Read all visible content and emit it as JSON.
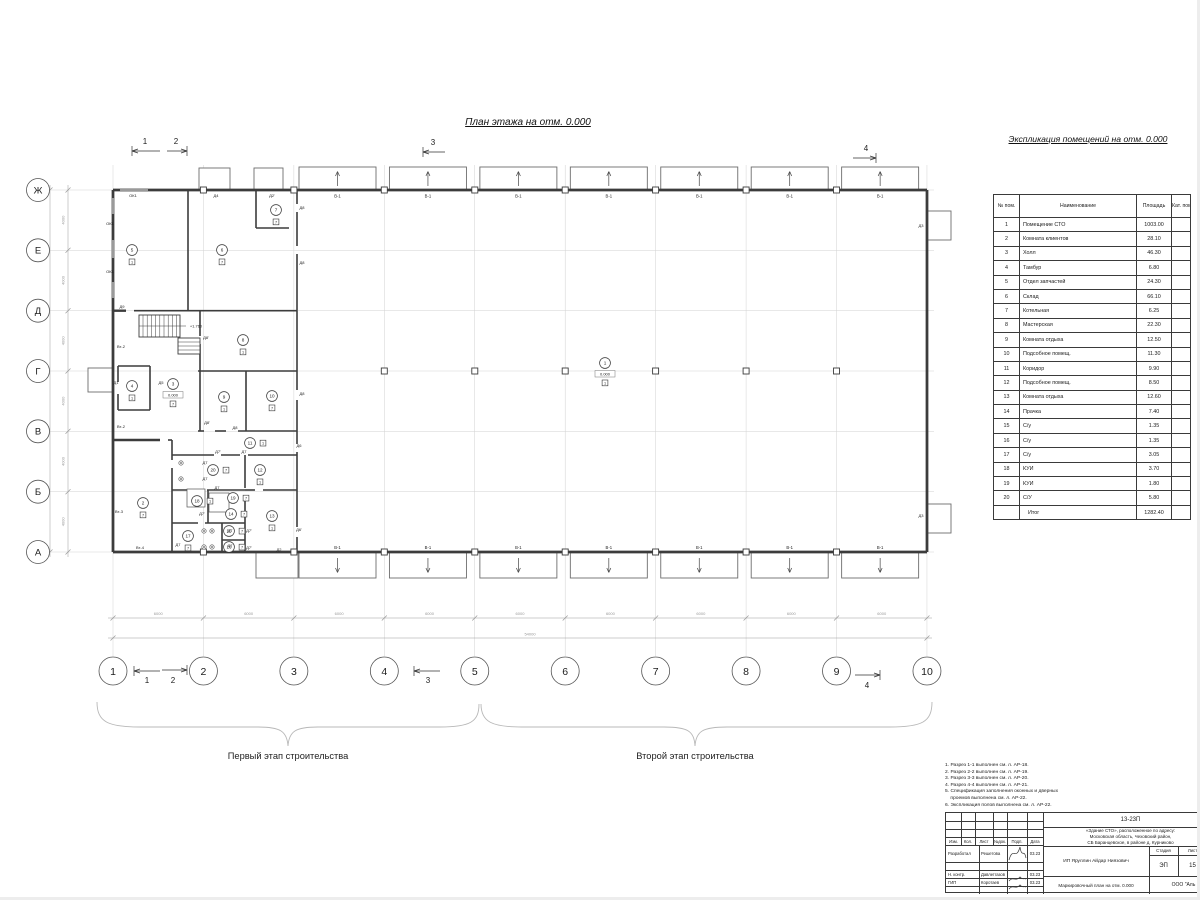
{
  "page": {
    "plan_title": "План этажа на отм. 0.000",
    "stage1": "Первый этап строительства",
    "stage2": "Второй этап строительства"
  },
  "explication": {
    "title": "Экспликация помещений на отм. 0.000",
    "col_num": "№ пом.",
    "col_name": "Наименование",
    "col_area": "Площадь",
    "col_cat": "Кат. пом.",
    "rows": [
      [
        "1",
        "Помещение СТО",
        "1003.00"
      ],
      [
        "2",
        "Комната клиентов",
        "28.10"
      ],
      [
        "3",
        "Холл",
        "46.30"
      ],
      [
        "4",
        "Тамбур",
        "6.80"
      ],
      [
        "5",
        "Отдел запчастей",
        "24.30"
      ],
      [
        "6",
        "Склад",
        "66.10"
      ],
      [
        "7",
        "Котельная",
        "6.25"
      ],
      [
        "8",
        "Мастерская",
        "22.30"
      ],
      [
        "9",
        "Комната отдыха",
        "12.50"
      ],
      [
        "10",
        "Подсобное помещ.",
        "11.30"
      ],
      [
        "11",
        "Коридор",
        "9.90"
      ],
      [
        "12",
        "Подсобное помещ.",
        "8.50"
      ],
      [
        "13",
        "Комната отдыха",
        "12.60"
      ],
      [
        "14",
        "Прачка",
        "7.40"
      ],
      [
        "15",
        "С/у",
        "1.35"
      ],
      [
        "16",
        "С/у",
        "1.35"
      ],
      [
        "17",
        "С/у",
        "3.05"
      ],
      [
        "18",
        "КУИ",
        "3.70"
      ],
      [
        "19",
        "КУИ",
        "1.80"
      ],
      [
        "20",
        "С/У",
        "5.80"
      ]
    ],
    "total_label": "Итог",
    "total": "1282.40"
  },
  "plan": {
    "axes_cols": [
      "1",
      "2",
      "3",
      "4",
      "5",
      "6",
      "7",
      "8",
      "9",
      "10"
    ],
    "axes_rows": [
      "Ж",
      "Е",
      "Д",
      "Г",
      "В",
      "Б",
      "А"
    ],
    "dim_bay": "6000",
    "dim_total_w": "54000",
    "dim_row": "4000",
    "dim_total_h": "24000",
    "gate": "В-1",
    "level_main": "0.000",
    "level_stair": "+1.760",
    "sections": [
      "1",
      "2",
      "3",
      "4"
    ],
    "rooms": [
      {
        "n": "1",
        "x": 605,
        "y": 363,
        "level": "0.000",
        "m": "1"
      },
      {
        "n": "2",
        "x": 143,
        "y": 503,
        "m": "7"
      },
      {
        "n": "3",
        "x": 173,
        "y": 384,
        "level": "0.000",
        "m": "7"
      },
      {
        "n": "4",
        "x": 132,
        "y": 386,
        "m": "1"
      },
      {
        "n": "5",
        "x": 132,
        "y": 250,
        "m": "1"
      },
      {
        "n": "6",
        "x": 222,
        "y": 250,
        "m": "7"
      },
      {
        "n": "7",
        "x": 276,
        "y": 210,
        "m": "7"
      },
      {
        "n": "8",
        "x": 243,
        "y": 340,
        "m": "1"
      },
      {
        "n": "9",
        "x": 224,
        "y": 397,
        "m": "1"
      },
      {
        "n": "10",
        "x": 272,
        "y": 396,
        "m": "7"
      },
      {
        "n": "11",
        "x": 250,
        "y": 443,
        "side": 1,
        "m": "1"
      },
      {
        "n": "12",
        "x": 260,
        "y": 470,
        "m": "1"
      },
      {
        "n": "13",
        "x": 272,
        "y": 516,
        "m": "1"
      },
      {
        "n": "14",
        "x": 231,
        "y": 514,
        "side": 1,
        "m": "7"
      },
      {
        "n": "15",
        "x": 229,
        "y": 531,
        "side": 1,
        "m": "7"
      },
      {
        "n": "16",
        "x": 229,
        "y": 547,
        "side": 1,
        "m": "7"
      },
      {
        "n": "17",
        "x": 188,
        "y": 536,
        "m": "7"
      },
      {
        "n": "18",
        "x": 197,
        "y": 501,
        "side": 1,
        "m": "1"
      },
      {
        "n": "19",
        "x": 233,
        "y": 498,
        "side": 1,
        "m": "7"
      },
      {
        "n": "20",
        "x": 213,
        "y": 470,
        "side": 1,
        "m": "7"
      }
    ],
    "labels": [
      {
        "t": "ОК1",
        "x": 133,
        "y": 197
      },
      {
        "t": "ОК1",
        "x": 110,
        "y": 225
      },
      {
        "t": "ОК1",
        "x": 110,
        "y": 273
      },
      {
        "t": "Д4",
        "x": 216,
        "y": 197
      },
      {
        "t": "Д2'",
        "x": 272,
        "y": 197
      },
      {
        "t": "Д8",
        "x": 302,
        "y": 209
      },
      {
        "t": "Д8",
        "x": 302,
        "y": 264
      },
      {
        "t": "Д8",
        "x": 302,
        "y": 395
      },
      {
        "t": "Д9",
        "x": 122,
        "y": 308
      },
      {
        "t": "Д1",
        "x": 116,
        "y": 384
      },
      {
        "t": "Д5",
        "x": 161,
        "y": 384
      },
      {
        "t": "Д8'",
        "x": 206,
        "y": 339
      },
      {
        "t": "Д8'",
        "x": 207,
        "y": 424
      },
      {
        "t": "Д8",
        "x": 235,
        "y": 429
      },
      {
        "t": "Д7'",
        "x": 218,
        "y": 453
      },
      {
        "t": "Д7",
        "x": 244,
        "y": 453
      },
      {
        "t": "Д7",
        "x": 205,
        "y": 464
      },
      {
        "t": "Д7",
        "x": 205,
        "y": 480
      },
      {
        "t": "Д7",
        "x": 217,
        "y": 489
      },
      {
        "t": "Д7'",
        "x": 202,
        "y": 515
      },
      {
        "t": "Д7",
        "x": 178,
        "y": 546
      },
      {
        "t": "Д7",
        "x": 230,
        "y": 532
      },
      {
        "t": "Д7'",
        "x": 249,
        "y": 532
      },
      {
        "t": "Д7",
        "x": 230,
        "y": 547
      },
      {
        "t": "Д7'",
        "x": 249,
        "y": 549
      },
      {
        "t": "Д6",
        "x": 299,
        "y": 447
      },
      {
        "t": "Д6'",
        "x": 299,
        "y": 531
      },
      {
        "t": "Д2",
        "x": 279,
        "y": 551
      },
      {
        "t": "Д3",
        "x": 921,
        "y": 227
      },
      {
        "t": "Д3",
        "x": 921,
        "y": 517
      },
      {
        "t": "Вт-2",
        "x": 121,
        "y": 348
      },
      {
        "t": "Вт-2",
        "x": 121,
        "y": 428
      },
      {
        "t": "Вт-3",
        "x": 119,
        "y": 513
      },
      {
        "t": "Вт-4",
        "x": 140,
        "y": 549
      }
    ]
  },
  "notes": [
    "1. Разрез 1-1 выполнен см. л. АР-18.",
    "2. Разрез 2-2 выполнен см. л. АР-19.",
    "3. Разрез 3-3 выполнен см. л. АР-20.",
    "4. Разрез 4-4 выполнен см. л. АР-21.",
    "5. Спецификация заполнения оконных и дверных",
    "    проемов выполнена см. л. АР-22.",
    "6. Экспликация полов выполнена см. л. АР-22."
  ],
  "titleblock": {
    "doc": "13-23П",
    "address": [
      "«Здание СТО», расположенное по адресу:",
      "Московская область, Чеховский район,",
      "СБ Баранцевское, в районе д. Курниково"
    ],
    "cols": [
      "Изм.",
      "Кол.",
      "Лист",
      "№док.",
      "Подп.",
      "Дата"
    ],
    "rows": [
      [
        "Разработал",
        "Решетова",
        "03.23"
      ],
      [
        "Н. контр.",
        "Давлетгазов",
        "03.23"
      ],
      [
        "ГИП",
        "Коротаев",
        "03.23"
      ]
    ],
    "client": "ИП Яруллин Айдар Ниязович",
    "stage_label": "Стадия",
    "stage": "ЭП",
    "sheet_label": "Лист",
    "sheet": "15",
    "drawing": "Маркировочный план на отм. 0.000",
    "company": "ООО \"Аль"
  }
}
